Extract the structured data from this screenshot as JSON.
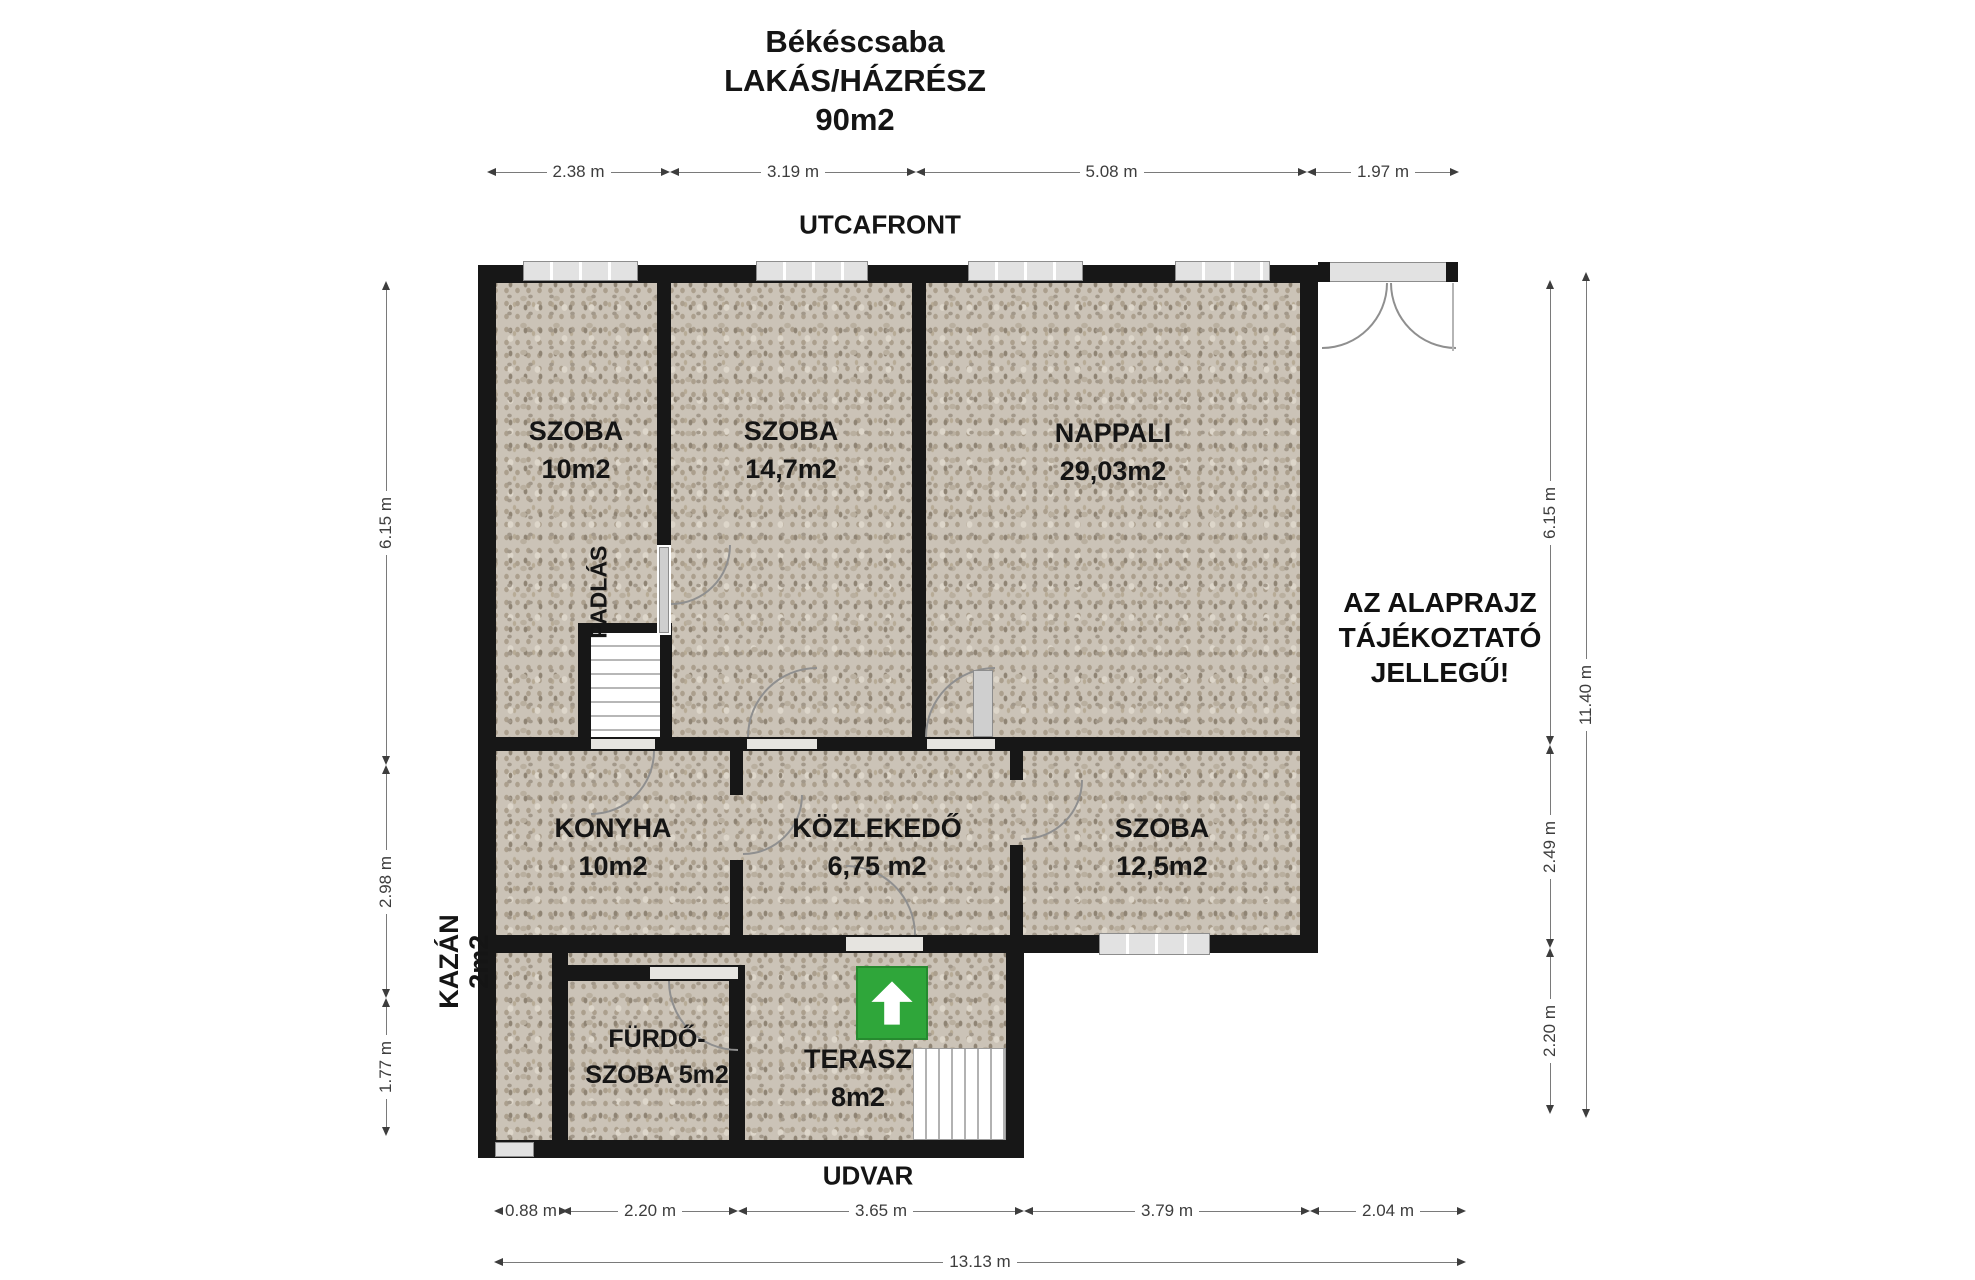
{
  "title": {
    "line1": "Békéscsaba",
    "line2": "LAKÁS/HÁZRÉSZ",
    "line3": "90m2"
  },
  "orientation": {
    "street": "UTCAFRONT",
    "yard": "UDVAR"
  },
  "disclaimer": {
    "line1": "AZ ALAPRAJZ",
    "line2": "TÁJÉKOZTATÓ",
    "line3": "JELLEGŰ!"
  },
  "rooms": {
    "szoba1": {
      "name": "SZOBA",
      "area": "10m2"
    },
    "szoba2": {
      "name": "SZOBA",
      "area": "14,7m2"
    },
    "nappali": {
      "name": "NAPPALI",
      "area": "29,03m2"
    },
    "konyha": {
      "name": "KONYHA",
      "area": "10m2"
    },
    "kozlekedo": {
      "name": "KÖZLEKEDŐ",
      "area": "6,75 m2"
    },
    "szoba3": {
      "name": "SZOBA",
      "area": "12,5m2"
    },
    "kazan": {
      "name": "KAZÁN",
      "area": "2m2"
    },
    "furdoszoba": {
      "name": "FÜRDŐ-",
      "area": "SZOBA 5m2"
    },
    "terasz": {
      "name": "TERASZ",
      "area": "8m2"
    },
    "padlas": {
      "name": "PADLÁS"
    }
  },
  "dimensions": {
    "top": [
      "2.38 m",
      "3.19 m",
      "5.08 m",
      "1.97 m"
    ],
    "bottom": [
      "0.88 m",
      "2.20 m",
      "3.65 m",
      "3.79 m",
      "2.04 m"
    ],
    "bottom_total": "13.13 m",
    "left": [
      "6.15 m",
      "2.98 m",
      "1.77 m"
    ],
    "right": [
      "6.15 m",
      "2.49 m",
      "2.20 m"
    ],
    "right_total": "11.40 m"
  },
  "icons": {
    "entrance_arrow": "up-arrow"
  },
  "colors": {
    "wall": "#171717",
    "floor": "#cbc3b7",
    "window": "#e2e2e2",
    "arrow_green": "#2fa63a",
    "dim_line": "#7a7a7a",
    "text": "#151515"
  }
}
